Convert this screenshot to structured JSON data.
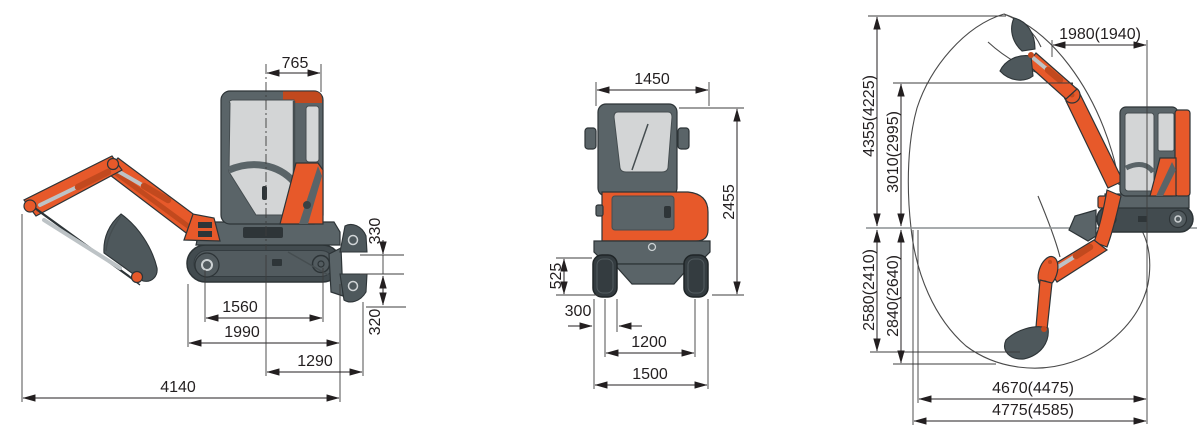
{
  "diagram_title": "mini-excavator-dimension-drawing",
  "colors": {
    "bg": "#FFFFFF",
    "orange": "#E7592A",
    "orange_dark": "#C2491E",
    "gray": "#5A6468",
    "gray_mid": "#525B5F",
    "bucket": "#4E585C",
    "trackside": "#424B4F",
    "trackfront": "#343C40",
    "window": "#D3D5D6",
    "silver": "#BDC3C6",
    "outline": "#2D3437",
    "dim": "#231F20",
    "ground": "#8A8F92"
  },
  "side_view": {
    "name": "side-view",
    "dims": {
      "upper_rear_length": "765",
      "blade_raise_height": "330",
      "blade_drop_depth": "320",
      "wheelbase": "1560",
      "track_length": "1990",
      "center_to_blade": "1290",
      "overall_length": "4140"
    }
  },
  "front_view": {
    "name": "front-view",
    "dims": {
      "cab_width": "1450",
      "overall_height": "2455",
      "track_height": "525",
      "shoe_width": "300",
      "track_gauge": "1200",
      "overall_width": "1500"
    }
  },
  "working_range": {
    "name": "working-range-view",
    "dims": {
      "top_swing_radius": "1980(1940)",
      "max_cutting_height": "4355(4225)",
      "max_dumping_height": "3010(2995)",
      "max_digging_depth": "2580(2410)",
      "max_vertical_digging_depth": "2840(2640)",
      "digging_reach_at_ground": "4670(4475)",
      "max_digging_reach": "4775(4585)"
    }
  }
}
